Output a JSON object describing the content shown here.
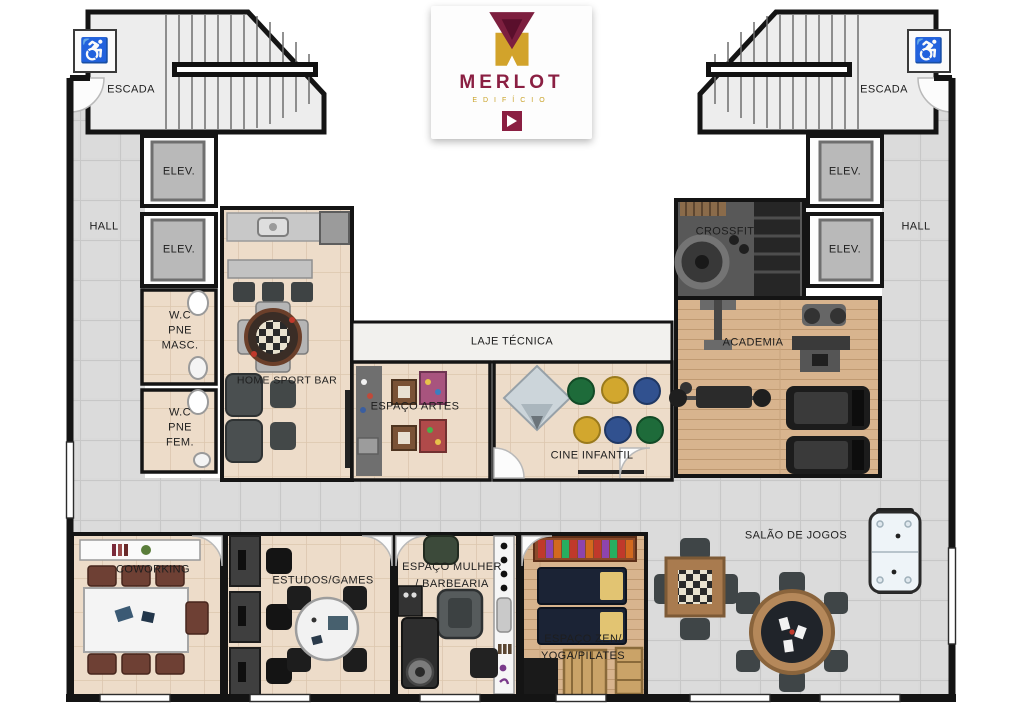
{
  "logo": {
    "title": "MERLOT",
    "subtitle": "EDIFÍCIO"
  },
  "colors": {
    "brand_maroon": "#7d1f3f",
    "brand_gold": "#d2a32b",
    "wall": "#161616",
    "floor_tile": "#d9d9d9",
    "floor_beige": "#eddcc9",
    "floor_wood": "#d8b48e",
    "floor_crossfit": "#585858"
  },
  "icons": {
    "wheelchair": "♿"
  },
  "rooms": {
    "escada_left": {
      "label": "ESCADA"
    },
    "escada_right": {
      "label": "ESCADA"
    },
    "hall_left": {
      "label": "HALL"
    },
    "hall_right": {
      "label": "HALL"
    },
    "elev_left_1": {
      "label": "ELEV."
    },
    "elev_left_2": {
      "label": "ELEV."
    },
    "elev_right_1": {
      "label": "ELEV."
    },
    "elev_right_2": {
      "label": "ELEV."
    },
    "wc_masc": {
      "lines": [
        "W.C",
        "PNE",
        "MASC."
      ]
    },
    "wc_fem": {
      "lines": [
        "W.C",
        "PNE",
        "FEM."
      ]
    },
    "home_sport_bar": {
      "label": "HOME SPORT BAR"
    },
    "laje_tecnica": {
      "label": "LAJE TÉCNICA"
    },
    "espaco_artes": {
      "label": "ESPAÇO ARTES"
    },
    "cine_infantil": {
      "label": "CINE INFANTIL"
    },
    "crossfit": {
      "label": "CROSSFIT"
    },
    "academia": {
      "label": "ACADEMIA"
    },
    "coworking": {
      "label": "COWORKING"
    },
    "estudos_games": {
      "label": "ESTUDOS/GAMES"
    },
    "espaco_mulher": {
      "lines": [
        "ESPAÇO MULHER",
        "/ BARBEARIA"
      ]
    },
    "espaco_zen": {
      "lines": [
        "ESPAÇO ZEN/",
        "YOGA/PILATES"
      ]
    },
    "salao_jogos": {
      "label": "SALÃO DE JOGOS"
    }
  }
}
